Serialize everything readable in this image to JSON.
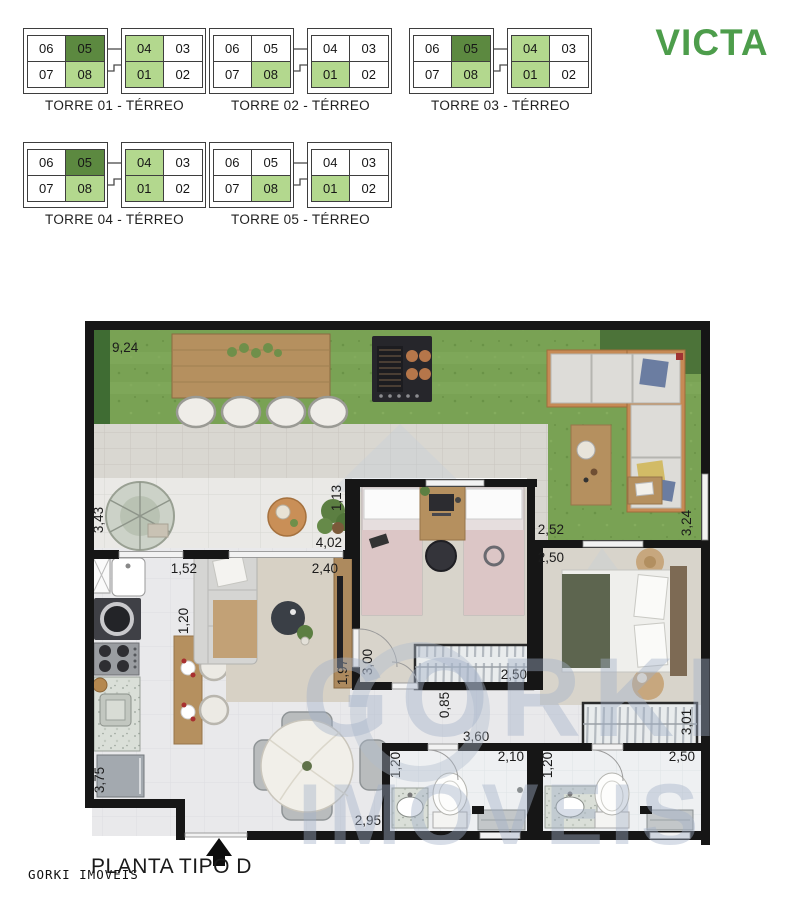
{
  "brand": {
    "name": "VICTA"
  },
  "towers": [
    {
      "label": "TORRE 01 - TÉRREO",
      "units": [
        {
          "no": "06",
          "hl": "none"
        },
        {
          "no": "05",
          "hl": "dark"
        },
        {
          "no": "04",
          "hl": "light"
        },
        {
          "no": "03",
          "hl": "none"
        },
        {
          "no": "07",
          "hl": "none"
        },
        {
          "no": "08",
          "hl": "light"
        },
        {
          "no": "01",
          "hl": "light"
        },
        {
          "no": "02",
          "hl": "none"
        }
      ]
    },
    {
      "label": "TORRE 02 - TÉRREO",
      "units": [
        {
          "no": "06",
          "hl": "none"
        },
        {
          "no": "05",
          "hl": "none"
        },
        {
          "no": "04",
          "hl": "none"
        },
        {
          "no": "03",
          "hl": "none"
        },
        {
          "no": "07",
          "hl": "none"
        },
        {
          "no": "08",
          "hl": "light"
        },
        {
          "no": "01",
          "hl": "light"
        },
        {
          "no": "02",
          "hl": "none"
        }
      ]
    },
    {
      "label": "TORRE 03 - TÉRREO",
      "units": [
        {
          "no": "06",
          "hl": "none"
        },
        {
          "no": "05",
          "hl": "dark"
        },
        {
          "no": "04",
          "hl": "light"
        },
        {
          "no": "03",
          "hl": "none"
        },
        {
          "no": "07",
          "hl": "none"
        },
        {
          "no": "08",
          "hl": "light"
        },
        {
          "no": "01",
          "hl": "light"
        },
        {
          "no": "02",
          "hl": "none"
        }
      ]
    },
    {
      "label": "TORRE 04 - TÉRREO",
      "units": [
        {
          "no": "06",
          "hl": "none"
        },
        {
          "no": "05",
          "hl": "dark"
        },
        {
          "no": "04",
          "hl": "light"
        },
        {
          "no": "03",
          "hl": "none"
        },
        {
          "no": "07",
          "hl": "none"
        },
        {
          "no": "08",
          "hl": "light"
        },
        {
          "no": "01",
          "hl": "light"
        },
        {
          "no": "02",
          "hl": "none"
        }
      ]
    },
    {
      "label": "TORRE 05 - TÉRREO",
      "units": [
        {
          "no": "06",
          "hl": "none"
        },
        {
          "no": "05",
          "hl": "none"
        },
        {
          "no": "04",
          "hl": "none"
        },
        {
          "no": "03",
          "hl": "none"
        },
        {
          "no": "07",
          "hl": "none"
        },
        {
          "no": "08",
          "hl": "light"
        },
        {
          "no": "01",
          "hl": "light"
        },
        {
          "no": "02",
          "hl": "none"
        }
      ]
    }
  ],
  "plan": {
    "title": "PLANTA TIPO D",
    "agency": "GORKI IMOVEIS",
    "watermark": {
      "line1": "GORKI",
      "line2": "IMOVEIS"
    },
    "colors": {
      "highlight_light": "#b3d88e",
      "highlight_dark": "#5c8940",
      "brand_green": "#4d9d4b"
    },
    "dims": {
      "garden_w": "9,24",
      "terrace_h": "3,43",
      "stub_h": "1,13",
      "terrace_w": "4,02",
      "kitchen_opening": "1,52",
      "living_opening": "2,40",
      "island_w": "1,20",
      "tv_w": "1,97",
      "bed2_h": "3,00",
      "bed2_ward_w": "2,50",
      "bed2_right_a": "2,52",
      "bed2_right_b": "2,50",
      "side_h": "3,24",
      "hall_h": "0,85",
      "hall_w": "3,60",
      "bath1_w": "2,10",
      "bath1_h": "1,20",
      "bath2_h": "1,20",
      "bath2_w": "2,50",
      "master_ward_h": "3,01",
      "kitchen_h": "3,75",
      "living_w": "2,95"
    }
  }
}
